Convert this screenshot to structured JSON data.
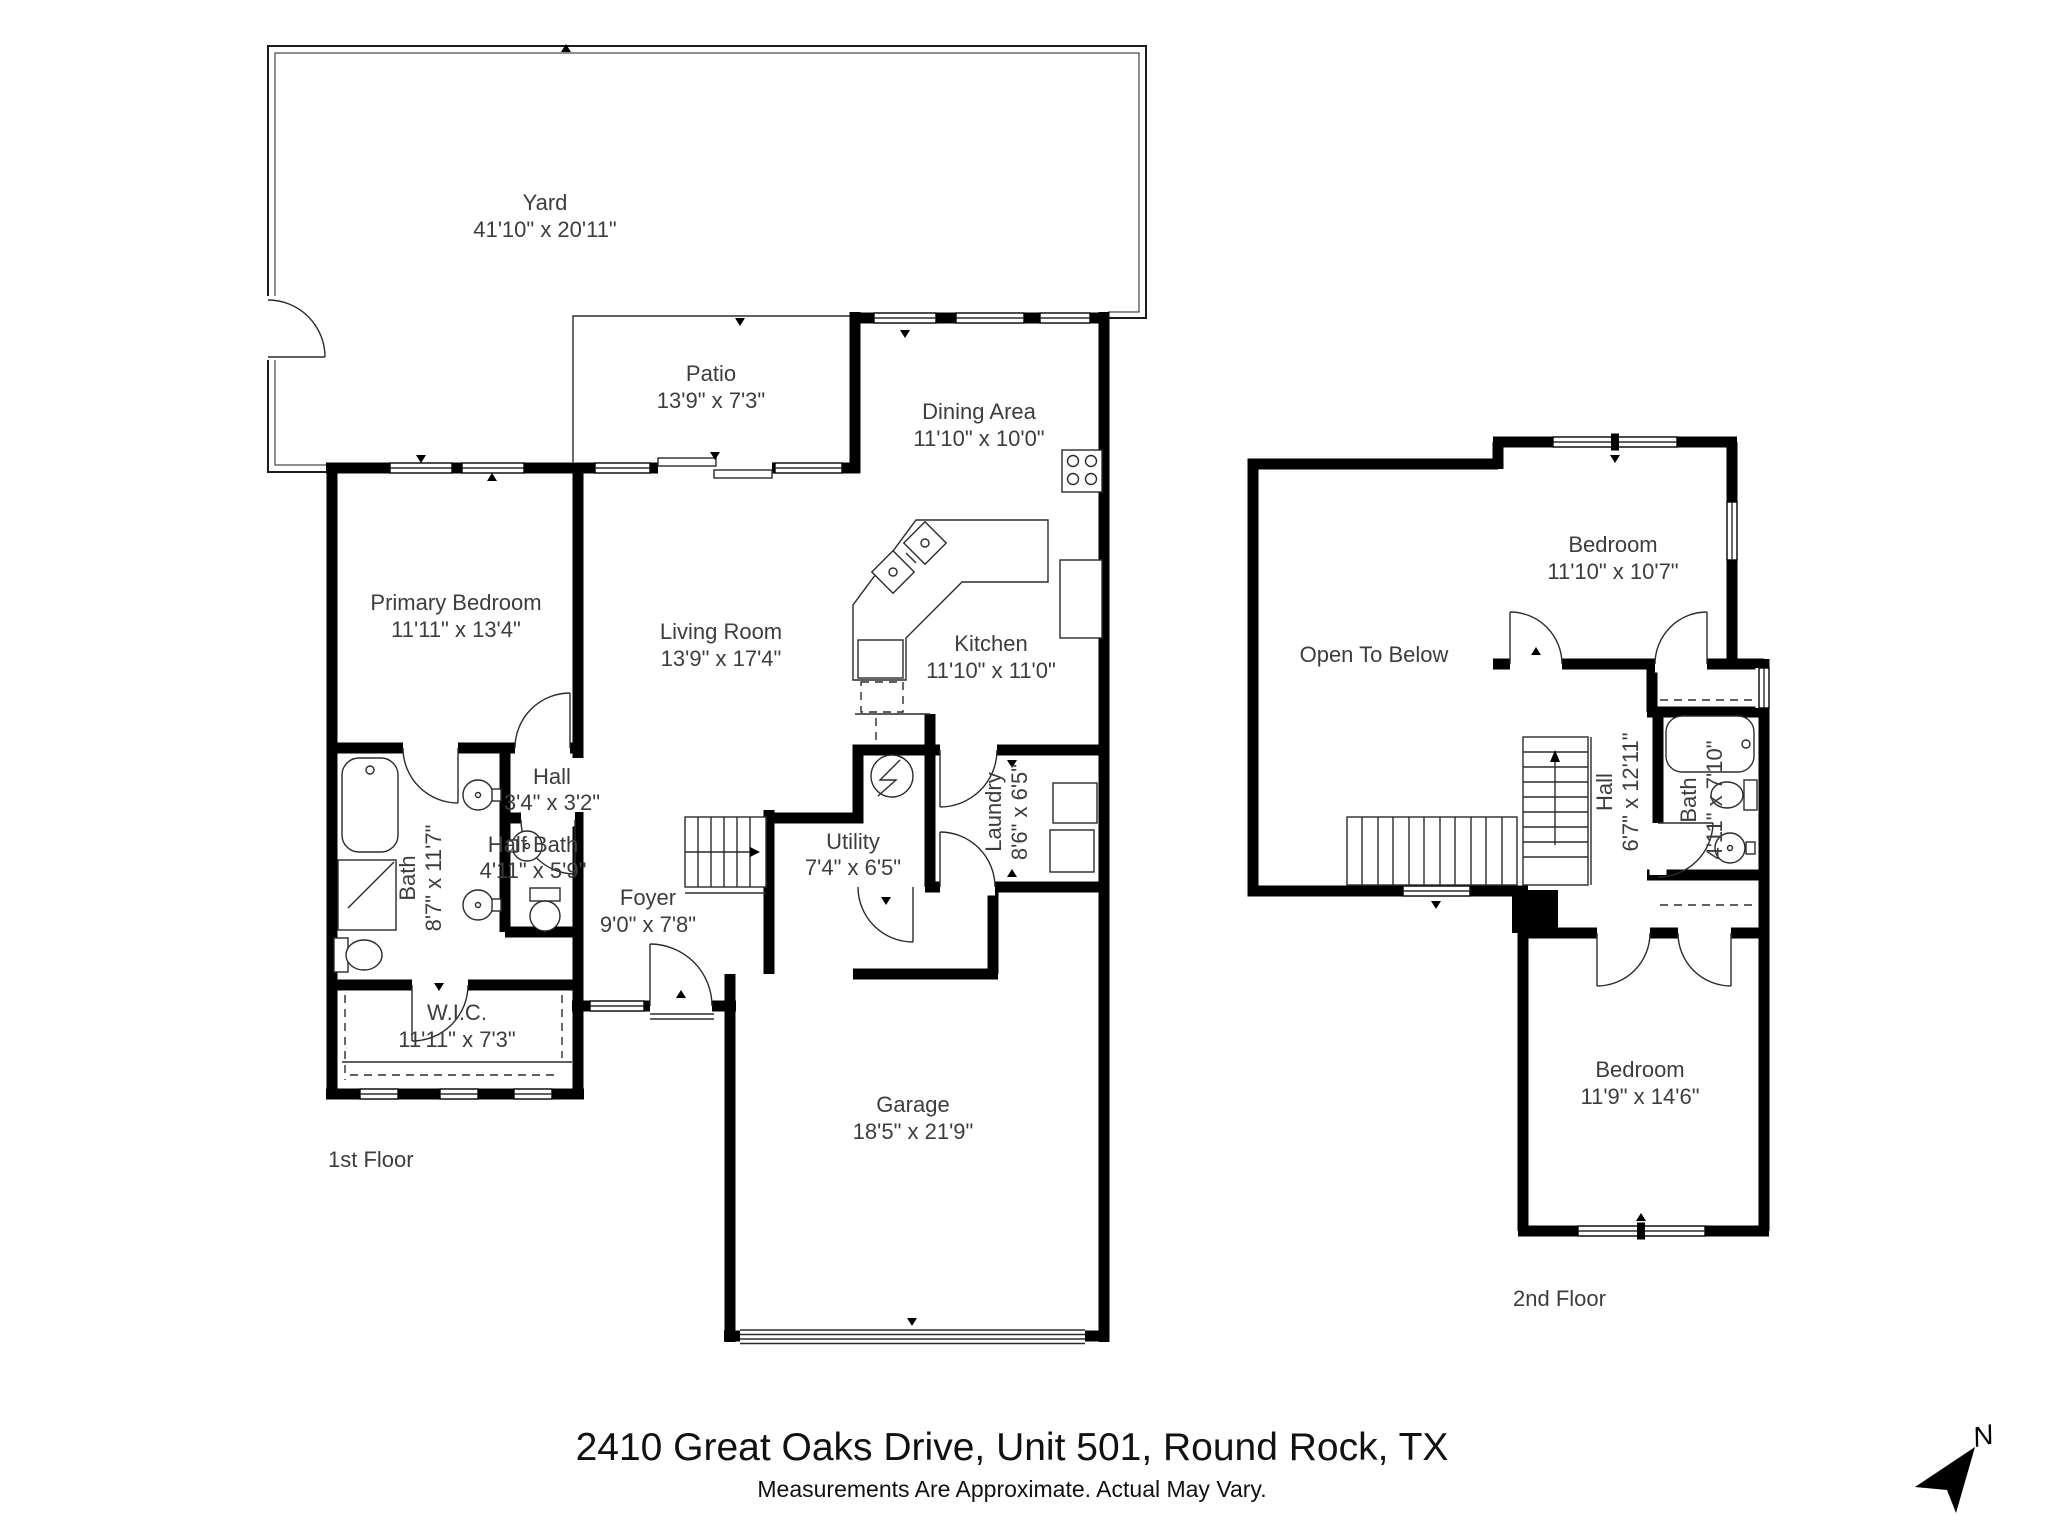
{
  "title": "2410 Great Oaks Drive, Unit 501, Round Rock, TX",
  "disclaimer": "Measurements Are Approximate. Actual May Vary.",
  "compass": {
    "label": "N"
  },
  "colors": {
    "wall": "#000000",
    "text": "#3d3d3d",
    "background": "#ffffff"
  },
  "floors": {
    "first": {
      "label": "1st Floor",
      "rooms": {
        "yard": {
          "name": "Yard",
          "dims": "41'10\" x 20'11\""
        },
        "patio": {
          "name": "Patio",
          "dims": "13'9\" x 7'3\""
        },
        "dining": {
          "name": "Dining Area",
          "dims": "11'10\" x 10'0\""
        },
        "primary": {
          "name": "Primary Bedroom",
          "dims": "11'11\" x 13'4\""
        },
        "living": {
          "name": "Living Room",
          "dims": "13'9\" x 17'4\""
        },
        "kitchen": {
          "name": "Kitchen",
          "dims": "11'10\" x 11'0\""
        },
        "hall": {
          "name": "Hall",
          "dims": "3'4\" x 3'2\""
        },
        "half_bath": {
          "name": "Half Bath",
          "dims": "4'11\" x 5'9\""
        },
        "bath": {
          "name": "Bath",
          "dims": "8'7\" x 11'7\""
        },
        "utility": {
          "name": "Utility",
          "dims": "7'4\" x 6'5\""
        },
        "laundry": {
          "name": "Laundry",
          "dims": "8'6\" x 6'5\""
        },
        "foyer": {
          "name": "Foyer",
          "dims": "9'0\" x 7'8\""
        },
        "wic": {
          "name": "W.I.C.",
          "dims": "11'11\" x 7'3\""
        },
        "garage": {
          "name": "Garage",
          "dims": "18'5\" x 21'9\""
        }
      }
    },
    "second": {
      "label": "2nd Floor",
      "rooms": {
        "open_to_below": {
          "name": "Open To Below",
          "dims": ""
        },
        "bedroom_top": {
          "name": "Bedroom",
          "dims": "11'10\" x 10'7\""
        },
        "hall": {
          "name": "Hall",
          "dims": "6'7\" x 12'11\""
        },
        "bath": {
          "name": "Bath",
          "dims": "4'11\" x 7'10\""
        },
        "bedroom_bottom": {
          "name": "Bedroom",
          "dims": "11'9\" x 14'6\""
        }
      }
    }
  }
}
